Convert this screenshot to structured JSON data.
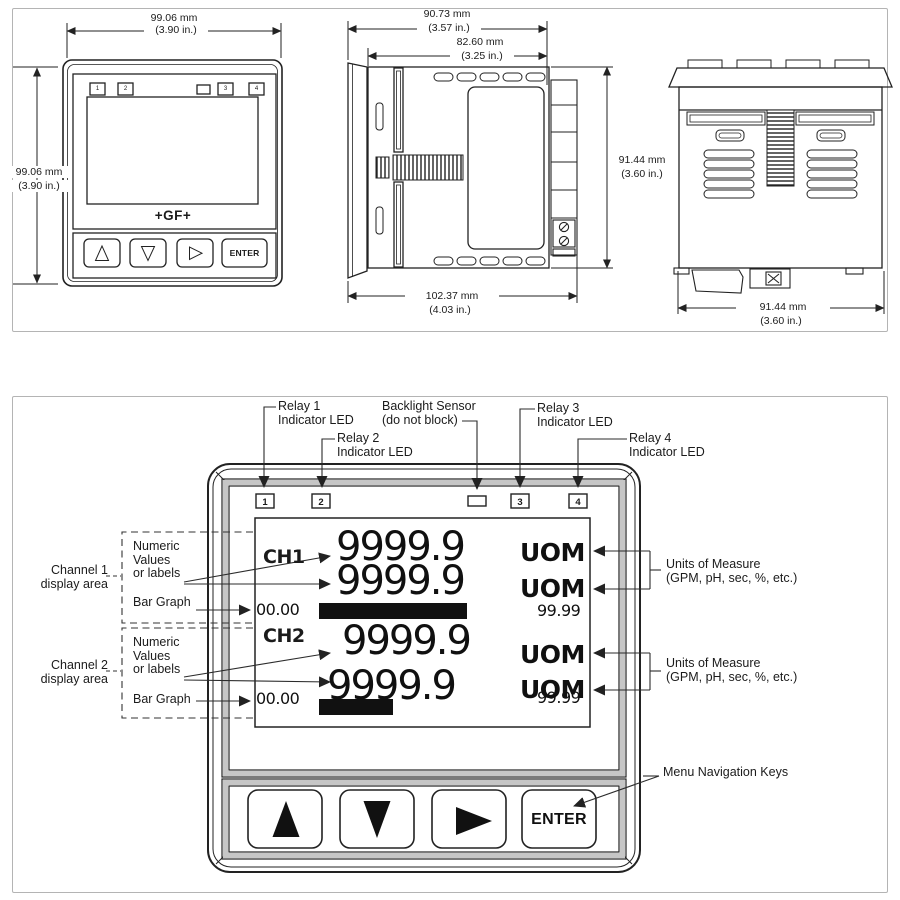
{
  "colors": {
    "ink": "#222222",
    "panel_border": "#b4b4b4",
    "frame_gray": "#c6c6c6",
    "bar_fill": "#111111",
    "background": "#ffffff"
  },
  "top_panel": {
    "front": {
      "dims": {
        "width_mm": "99.06 mm",
        "width_in": "(3.90 in.)",
        "height_mm": "99.06 mm",
        "height_in": "(3.90 in.)"
      },
      "logo": "+GF+",
      "enter": "ENTER",
      "leds": [
        "1",
        "2",
        "3",
        "4"
      ]
    },
    "side": {
      "dims": {
        "bezel_mm": "90.73 mm",
        "bezel_in": "(3.57 in.)",
        "case_mm": "82.60 mm",
        "case_in": "(3.25 in.)",
        "depth_mm": "102.37 mm",
        "depth_in": "(4.03 in.)",
        "height_mm": "91.44 mm",
        "height_in": "(3.60 in.)"
      }
    },
    "rear": {
      "dims": {
        "width_mm": "91.44 mm",
        "width_in": "(3.60 in.)"
      }
    }
  },
  "bottom_panel": {
    "callouts": {
      "relay1": {
        "line1": "Relay 1",
        "line2": "Indicator LED"
      },
      "relay2": {
        "line1": "Relay 2",
        "line2": "Indicator LED"
      },
      "backlight": {
        "line1": "Backlight Sensor",
        "line2": "(do not block)"
      },
      "relay3": {
        "line1": "Relay 3",
        "line2": "Indicator LED"
      },
      "relay4": {
        "line1": "Relay 4",
        "line2": "Indicator LED"
      },
      "channel1": {
        "line1": "Channel 1",
        "line2": "display area"
      },
      "numeric1": {
        "line1": "Numeric",
        "line2": "Values",
        "line3": "or labels"
      },
      "bargraph1": "Bar Graph",
      "channel2": {
        "line1": "Channel 2",
        "line2": "display area"
      },
      "numeric2": {
        "line1": "Numeric",
        "line2": "Values",
        "line3": "or labels"
      },
      "bargraph2": "Bar Graph",
      "uom1": {
        "line1": "Units of Measure",
        "line2": "(GPM, pH, sec, %, etc.)"
      },
      "uom2": {
        "line1": "Units of Measure",
        "line2": "(GPM, pH, sec, %, etc.)"
      },
      "menu_keys": "Menu Navigation Keys"
    },
    "leds": [
      "1",
      "2",
      "3",
      "4"
    ],
    "display": {
      "ch1": {
        "label": "CH1",
        "value1": "9999.9",
        "uom1": "UOM",
        "value2": "9999.9",
        "uom2": "UOM",
        "bar_min": "00.00",
        "bar_max": "99.99",
        "bar_fill_pct": 100
      },
      "ch2": {
        "label": "CH2",
        "value1": "9999.9",
        "uom1": "UOM",
        "value2": "9999.9",
        "uom2": "UOM",
        "bar_min": "00.00",
        "bar_max": "99.99",
        "bar_fill_pct": 49
      }
    },
    "keys": {
      "enter": "ENTER"
    }
  }
}
